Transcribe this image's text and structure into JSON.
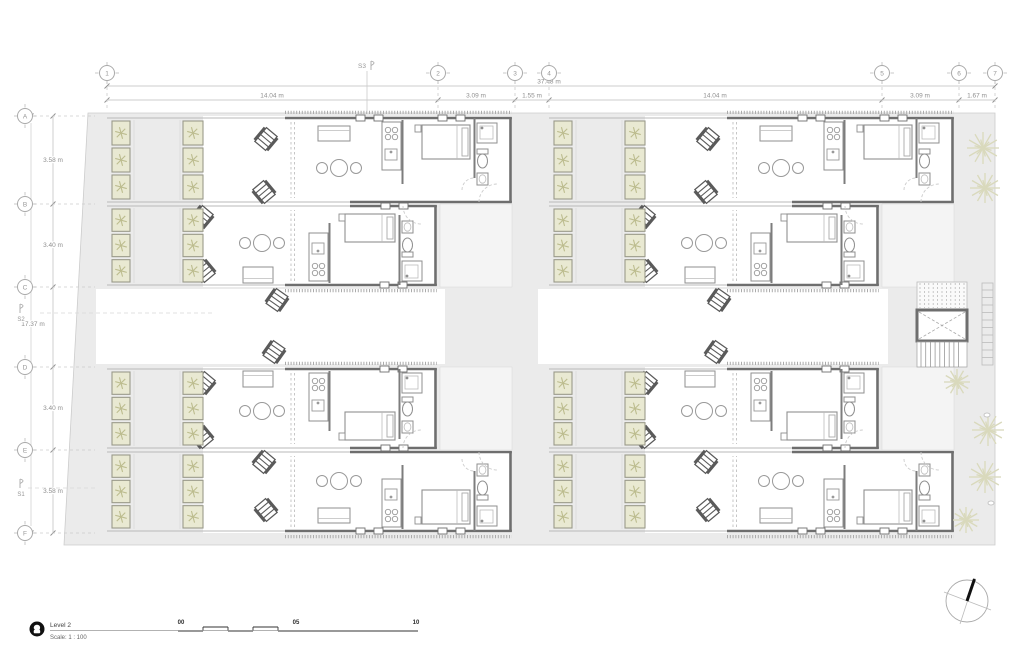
{
  "title_block": {
    "badge": "2",
    "title": "Level 2",
    "scale": "Scale:  1 : 100"
  },
  "scale_bar": {
    "labels": [
      "00",
      "05",
      "10"
    ]
  },
  "grid": {
    "columns": [
      {
        "label": "1"
      },
      {
        "label": "2"
      },
      {
        "label": "3"
      },
      {
        "label": "4"
      },
      {
        "label": "5"
      },
      {
        "label": "6"
      },
      {
        "label": "7"
      }
    ],
    "rows": [
      {
        "label": "A"
      },
      {
        "label": "B"
      },
      {
        "label": "C"
      },
      {
        "label": "D"
      },
      {
        "label": "E"
      },
      {
        "label": "F"
      }
    ]
  },
  "dimensions": {
    "overall_top": "37.48 m",
    "top_segments": [
      "14.04 m",
      "3.09 m",
      "1.55 m",
      "14.04 m",
      "3.09 m",
      "1.67 m"
    ],
    "left_segments": [
      "3.58 m",
      "3.40 m",
      "3.40 m",
      "3.58 m"
    ],
    "overall_left": "17.37 m"
  },
  "sections": {
    "s1": "S1",
    "s2": "S2",
    "s3": "S3"
  },
  "colors": {
    "site": "#ebebeb",
    "corridor": "#f4f4f4",
    "wall": "#6e6e6e",
    "partition": "#7d7d7d",
    "lightline": "#b9b9b9",
    "furniture": "#8f8f8f",
    "chair": "#5a5a5a",
    "planter_fill": "#e9e9d2",
    "planter_stroke": "#9a9a8a",
    "plant": "#bcbc8e",
    "tree": "#d9d9bc",
    "dim_text": "#8f8f8f",
    "grid_text": "#979797",
    "dark_text": "#2f2f2f",
    "arc": "#cccccc"
  }
}
